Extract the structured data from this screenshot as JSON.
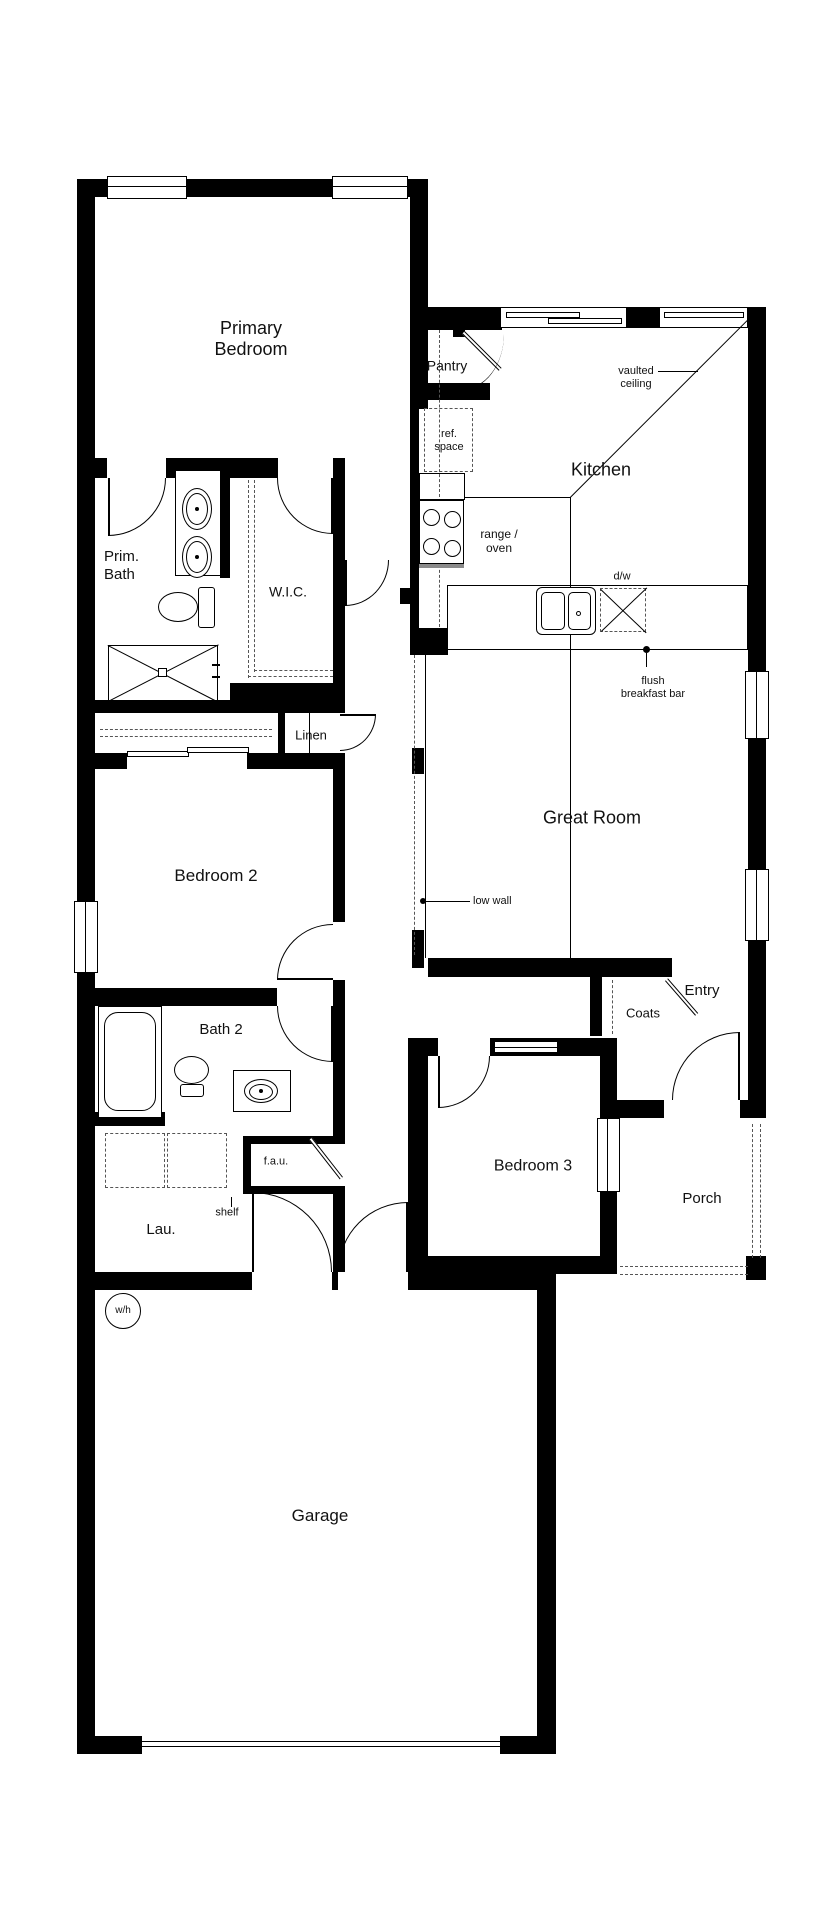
{
  "labels": {
    "primary_bedroom": "Primary Bedroom",
    "pantry": "Pantry",
    "vaulted_ceiling": "vaulted ceiling",
    "ref_space": "ref. space",
    "kitchen": "Kitchen",
    "range_oven": "range / oven",
    "prim_bath": "Prim. Bath",
    "wic": "W.I.C.",
    "dw": "d/w",
    "flush_breakfast_bar": "flush breakfast bar",
    "linen": "Linen",
    "great_room": "Great Room",
    "bedroom2": "Bedroom 2",
    "low_wall": "low wall",
    "entry": "Entry",
    "coats": "Coats",
    "bath2": "Bath 2",
    "bedroom3": "Bedroom 3",
    "fau": "f.a.u.",
    "porch": "Porch",
    "shelf": "shelf",
    "lau": "Lau.",
    "wh": "w/h",
    "garage": "Garage"
  },
  "colors": {
    "wall": "#000000",
    "line": "#1a1a1a",
    "dashed": "#555555",
    "background": "#ffffff"
  }
}
